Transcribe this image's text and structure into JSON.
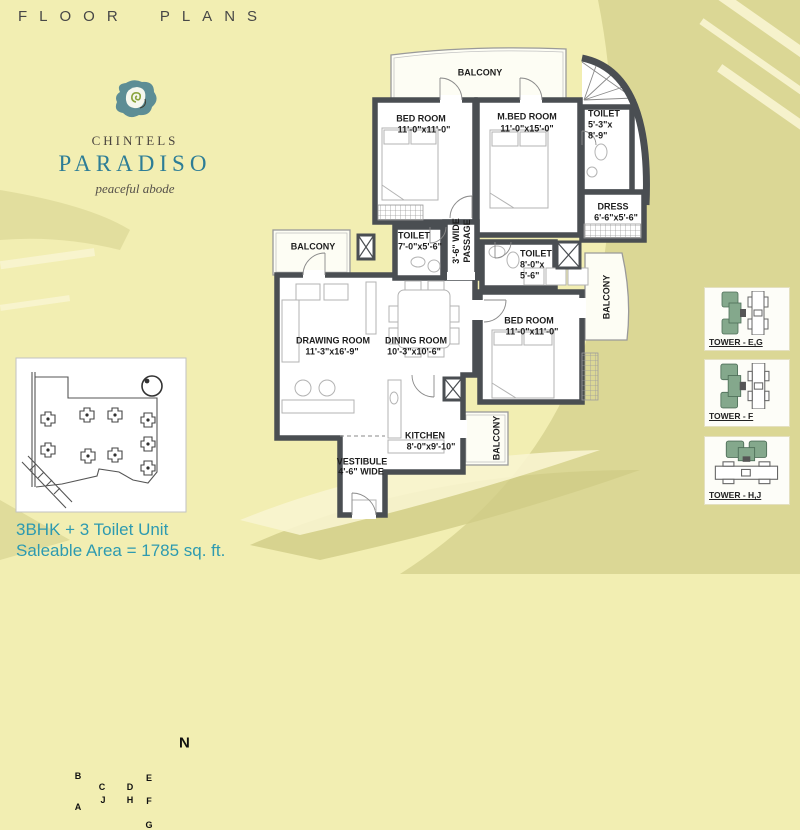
{
  "header": {
    "title": "FLOOR PLANS"
  },
  "brand": {
    "name": "CHINTELS",
    "product": "PARADISO",
    "tagline": "peaceful abode"
  },
  "floor_plan": {
    "balcony_top": {
      "label": "BALCONY"
    },
    "balcony_left": {
      "label": "BALCONY"
    },
    "balcony_right": {
      "label": "BALCONY"
    },
    "balcony_bottom": {
      "label": "BALCONY"
    },
    "bed1": {
      "name": "BED ROOM",
      "dims": "11'-0\"x11'-0\""
    },
    "mbed": {
      "name": "M.BED ROOM",
      "dims": "11'-0\"x15'-0\""
    },
    "toilet_m": {
      "name": "TOILET",
      "dims1": "5'-3\"x",
      "dims2": "8'-9\""
    },
    "dress": {
      "name": "DRESS",
      "dims": "6'-6\"x5'-6\""
    },
    "toilet2": {
      "name": "TOILET",
      "dims": "7'-0\"x5'-6\""
    },
    "passage": {
      "line1": "3'-6\" WIDE",
      "line2": "PASSAGE"
    },
    "toilet3": {
      "name": "TOILET",
      "dims1": "8'-0\"x",
      "dims2": "5'-6\""
    },
    "bed2": {
      "name": "BED ROOM",
      "dims": "11'-0\"x11'-0\""
    },
    "drawing": {
      "name": "DRAWING ROOM",
      "dims": "11'-3\"x16'-9\""
    },
    "dining": {
      "name": "DINING ROOM",
      "dims": "10'-3\"x10'-6\""
    },
    "kitchen": {
      "name": "KITCHEN",
      "dims": "8'-0\"x9'-10\""
    },
    "vestibule": {
      "name": "VESTIBULE",
      "dims": "4'-6\" WIDE"
    }
  },
  "site_plan": {
    "compass": "N",
    "towers": [
      "B",
      "C",
      "D",
      "E",
      "A",
      "J",
      "H",
      "F",
      "G"
    ]
  },
  "unit_info": {
    "line1": "3BHK + 3 Toilet Unit",
    "line2": "Saleable Area = 1785 sq. ft."
  },
  "tower_keys": [
    {
      "label": "TOWER - E,G"
    },
    {
      "label": "TOWER - F"
    },
    {
      "label": "TOWER - H,J"
    }
  ],
  "colors": {
    "accent_teal": "#2d9ab0",
    "wall_gray": "#4a4e52",
    "highlight_green": "#84a88c",
    "background": "#f2eeb2",
    "swirl_dark": "#dbd795",
    "swirl_light": "#f8f4cf"
  }
}
